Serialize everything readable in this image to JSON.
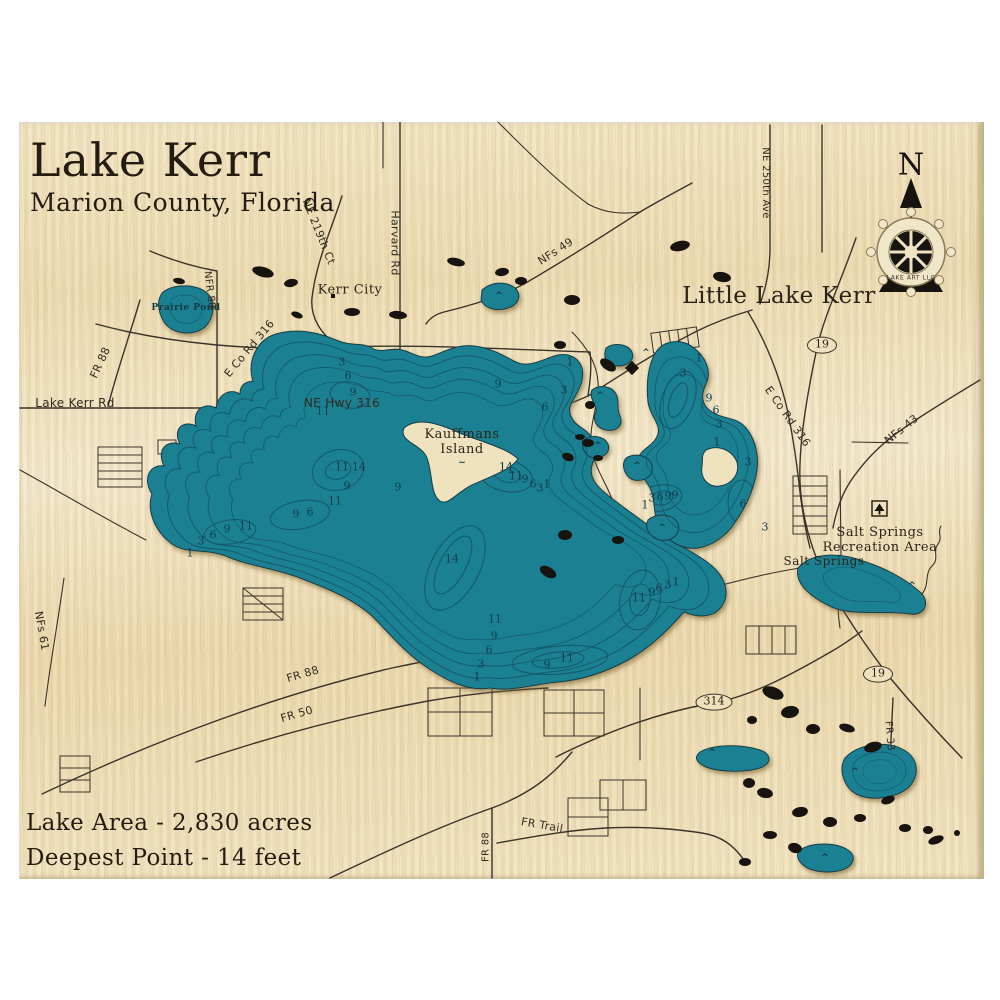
{
  "header": {
    "title": "Lake Kerr",
    "subtitle": "Marion County, Florida"
  },
  "footer": {
    "area": "Lake Area - 2,830 acres",
    "deepest": "Deepest Point - 14 feet"
  },
  "compass": {
    "north": "N",
    "brand": "LAKE ART LLC"
  },
  "colors": {
    "wood": "#f0e2bd",
    "water": "#1a8093",
    "contour": "#14576a",
    "road": "#3b332a",
    "ink": "#2b2317",
    "wetland": "#17140f"
  },
  "place_labels": [
    {
      "t": "Little Lake Kerr",
      "x": 779,
      "y": 296,
      "fs": 23
    },
    {
      "t": "Kerr City",
      "x": 350,
      "y": 291,
      "fs": 13
    },
    {
      "t": "Kauffmans\nIsland",
      "x": 462,
      "y": 443,
      "fs": 13
    },
    {
      "t": "Prairie Pond",
      "x": 186,
      "y": 308,
      "fs": 9,
      "c": "pond-text"
    },
    {
      "t": "Salt Springs",
      "x": 824,
      "y": 562,
      "fs": 12
    },
    {
      "t": "Salt Springs\nRecreation Area",
      "x": 880,
      "y": 541,
      "fs": 13
    }
  ],
  "road_labels": [
    {
      "t": "NE 219th Ct",
      "x": 318,
      "y": 232,
      "r": 68
    },
    {
      "t": "Harvard Rd",
      "x": 394,
      "y": 243,
      "r": 90
    },
    {
      "t": "NFs 49",
      "x": 556,
      "y": 252,
      "r": -33
    },
    {
      "t": "NE 250th Ave",
      "x": 765,
      "y": 183,
      "r": 90,
      "fs": 10
    },
    {
      "t": "NFR 88",
      "x": 209,
      "y": 290,
      "r": 83,
      "fs": 10
    },
    {
      "t": "FR 88",
      "x": 101,
      "y": 363,
      "r": -65
    },
    {
      "t": "E Co Rd 316",
      "x": 250,
      "y": 349,
      "r": -50
    },
    {
      "t": "Lake Kerr Rd",
      "x": 75,
      "y": 404,
      "r": 0,
      "fs": 12
    },
    {
      "t": "NE Hwy 316",
      "x": 342,
      "y": 404,
      "r": 0,
      "fs": 12
    },
    {
      "t": "E Co Rd 316",
      "x": 787,
      "y": 417,
      "r": 55
    },
    {
      "t": "NFs 43",
      "x": 902,
      "y": 430,
      "r": -39
    },
    {
      "t": "NFs 61",
      "x": 41,
      "y": 631,
      "r": 80
    },
    {
      "t": "FR 88",
      "x": 303,
      "y": 675,
      "r": -16
    },
    {
      "t": "FR 50",
      "x": 297,
      "y": 715,
      "r": -16
    },
    {
      "t": "FR 33",
      "x": 889,
      "y": 736,
      "r": 85,
      "fs": 10
    },
    {
      "t": "FR 88",
      "x": 486,
      "y": 847,
      "r": -90,
      "fs": 10
    },
    {
      "t": "FR Trail",
      "x": 542,
      "y": 826,
      "r": 10
    }
  ],
  "route_shields": [
    {
      "t": "19",
      "x": 822,
      "y": 345
    },
    {
      "t": "314",
      "x": 714,
      "y": 702
    },
    {
      "t": "19",
      "x": 878,
      "y": 674
    }
  ],
  "depth_labels": [
    {
      "t": "3",
      "x": 342,
      "y": 363
    },
    {
      "t": "6",
      "x": 348,
      "y": 377
    },
    {
      "t": "9",
      "x": 353,
      "y": 393
    },
    {
      "t": "11",
      "x": 323,
      "y": 412
    },
    {
      "t": "9",
      "x": 498,
      "y": 385
    },
    {
      "t": "1",
      "x": 570,
      "y": 363
    },
    {
      "t": "3",
      "x": 564,
      "y": 391
    },
    {
      "t": "6",
      "x": 545,
      "y": 408
    },
    {
      "t": "11",
      "x": 342,
      "y": 468
    },
    {
      "t": "14",
      "x": 359,
      "y": 468
    },
    {
      "t": "9",
      "x": 347,
      "y": 487
    },
    {
      "t": "9",
      "x": 398,
      "y": 488
    },
    {
      "t": "11",
      "x": 335,
      "y": 502
    },
    {
      "t": "9",
      "x": 296,
      "y": 515
    },
    {
      "t": "6",
      "x": 310,
      "y": 513
    },
    {
      "t": "9",
      "x": 227,
      "y": 530
    },
    {
      "t": "11",
      "x": 246,
      "y": 527
    },
    {
      "t": "6",
      "x": 213,
      "y": 536
    },
    {
      "t": "3",
      "x": 201,
      "y": 542
    },
    {
      "t": "1",
      "x": 190,
      "y": 554
    },
    {
      "t": "14",
      "x": 506,
      "y": 468
    },
    {
      "t": "11",
      "x": 516,
      "y": 477
    },
    {
      "t": "9",
      "x": 525,
      "y": 480
    },
    {
      "t": "6",
      "x": 533,
      "y": 485
    },
    {
      "t": "3",
      "x": 540,
      "y": 489
    },
    {
      "t": "1",
      "x": 547,
      "y": 485
    },
    {
      "t": "14",
      "x": 452,
      "y": 560
    },
    {
      "t": "11",
      "x": 495,
      "y": 620
    },
    {
      "t": "9",
      "x": 494,
      "y": 637
    },
    {
      "t": "6",
      "x": 489,
      "y": 651
    },
    {
      "t": "3",
      "x": 481,
      "y": 665
    },
    {
      "t": "1",
      "x": 477,
      "y": 678
    },
    {
      "t": "11",
      "x": 567,
      "y": 659
    },
    {
      "t": "9",
      "x": 547,
      "y": 666
    },
    {
      "t": "11",
      "x": 639,
      "y": 599
    },
    {
      "t": "9",
      "x": 652,
      "y": 593
    },
    {
      "t": "6",
      "x": 659,
      "y": 589
    },
    {
      "t": "3",
      "x": 668,
      "y": 586
    },
    {
      "t": "1",
      "x": 676,
      "y": 583
    },
    {
      "t": "1",
      "x": 699,
      "y": 359
    },
    {
      "t": "3",
      "x": 683,
      "y": 374
    },
    {
      "t": "9",
      "x": 709,
      "y": 399
    },
    {
      "t": "6",
      "x": 716,
      "y": 411
    },
    {
      "t": "3",
      "x": 719,
      "y": 425
    },
    {
      "t": "1",
      "x": 717,
      "y": 443
    },
    {
      "t": "3",
      "x": 748,
      "y": 463
    },
    {
      "t": "6",
      "x": 743,
      "y": 505
    },
    {
      "t": "3",
      "x": 765,
      "y": 528
    },
    {
      "t": "1",
      "x": 645,
      "y": 506
    },
    {
      "t": "3",
      "x": 652,
      "y": 499
    },
    {
      "t": "6",
      "x": 660,
      "y": 498
    },
    {
      "t": "9",
      "x": 668,
      "y": 497
    },
    {
      "t": "9",
      "x": 675,
      "y": 496
    }
  ],
  "marsh_marks": [
    {
      "t": "^",
      "x": 646,
      "y": 353
    },
    {
      "t": "^",
      "x": 600,
      "y": 396
    },
    {
      "t": "^",
      "x": 598,
      "y": 446
    },
    {
      "t": "^",
      "x": 637,
      "y": 466
    },
    {
      "t": "^",
      "x": 662,
      "y": 528
    },
    {
      "t": "^",
      "x": 912,
      "y": 586
    },
    {
      "t": "^",
      "x": 712,
      "y": 753
    },
    {
      "t": "^",
      "x": 855,
      "y": 772
    },
    {
      "t": "^",
      "x": 825,
      "y": 858
    },
    {
      "t": "^",
      "x": 499,
      "y": 296
    },
    {
      "t": "~",
      "x": 512,
      "y": 473
    },
    {
      "t": "~",
      "x": 462,
      "y": 463
    }
  ]
}
